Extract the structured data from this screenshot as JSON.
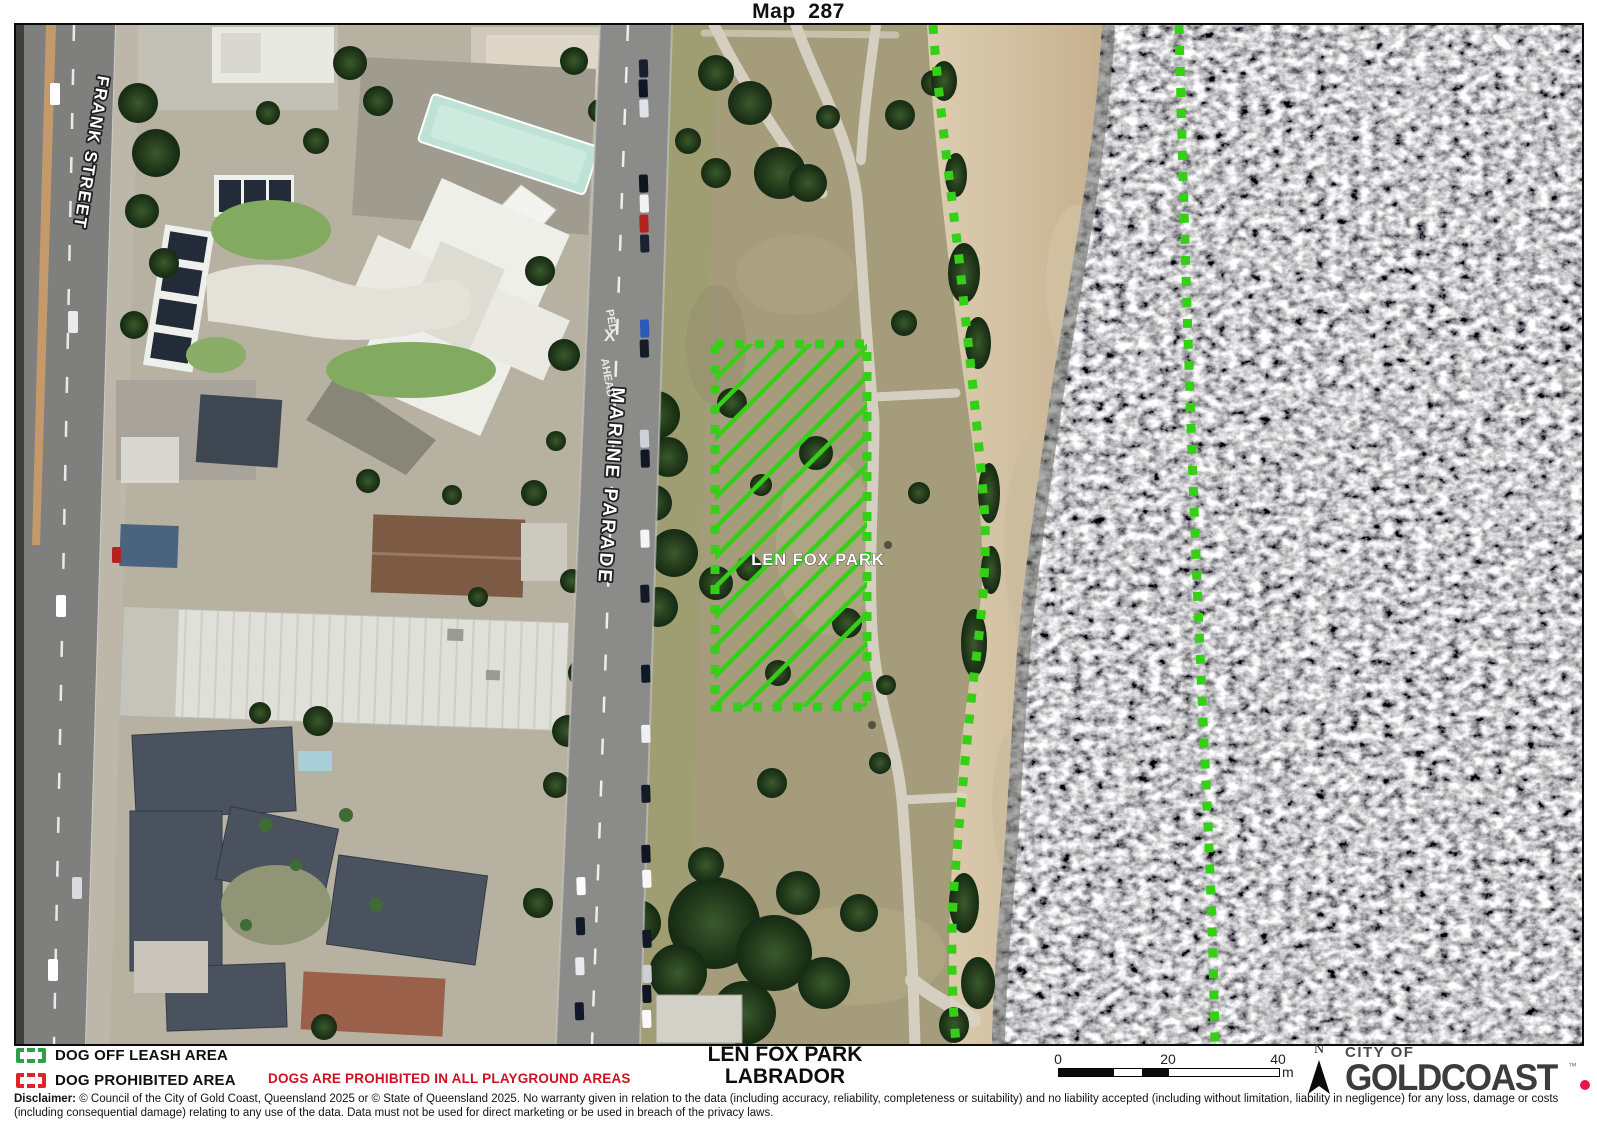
{
  "title": "Map  287",
  "map": {
    "street_labels": {
      "frank": "FRANK STREET",
      "marine": "MARINE PARADE"
    },
    "road_markings": {
      "ped": "PED",
      "x": "X",
      "ahead": "AHEAD"
    },
    "park_label": "LEN FOX PARK",
    "colors": {
      "off_leash_boundary": "#35cf17"
    }
  },
  "legend": {
    "items": [
      {
        "label": "DOG OFF LEASH AREA",
        "color": "#2f9e4c"
      },
      {
        "label": "DOG PROHIBITED AREA",
        "color": "#e32227"
      }
    ],
    "warning": "DOGS ARE PROHIBITED IN ALL PLAYGROUND AREAS"
  },
  "footer": {
    "park_name": "LEN FOX PARK",
    "suburb": "LABRADOR",
    "scale": {
      "ticks": [
        "0",
        "20",
        "40"
      ],
      "unit": "m"
    },
    "north_label": "N",
    "logo": {
      "city_of": "CITY OF",
      "name": "GOLDCOAST",
      "tm": "™",
      "dot_color": "#e8174a"
    }
  },
  "disclaimer": {
    "label": "Disclaimer:",
    "text": "© Council of the City of Gold Coast, Queensland 2025 or © State of Queensland 2025. No warranty given in relation to the data (including accuracy, reliability, completeness or suitability) and no liability accepted (including without limitation, liability in negligence) for any loss, damage or costs (including consequential damage) relating to any use of the data. Data must not be used for direct marketing or be used in breach of the privacy laws."
  }
}
